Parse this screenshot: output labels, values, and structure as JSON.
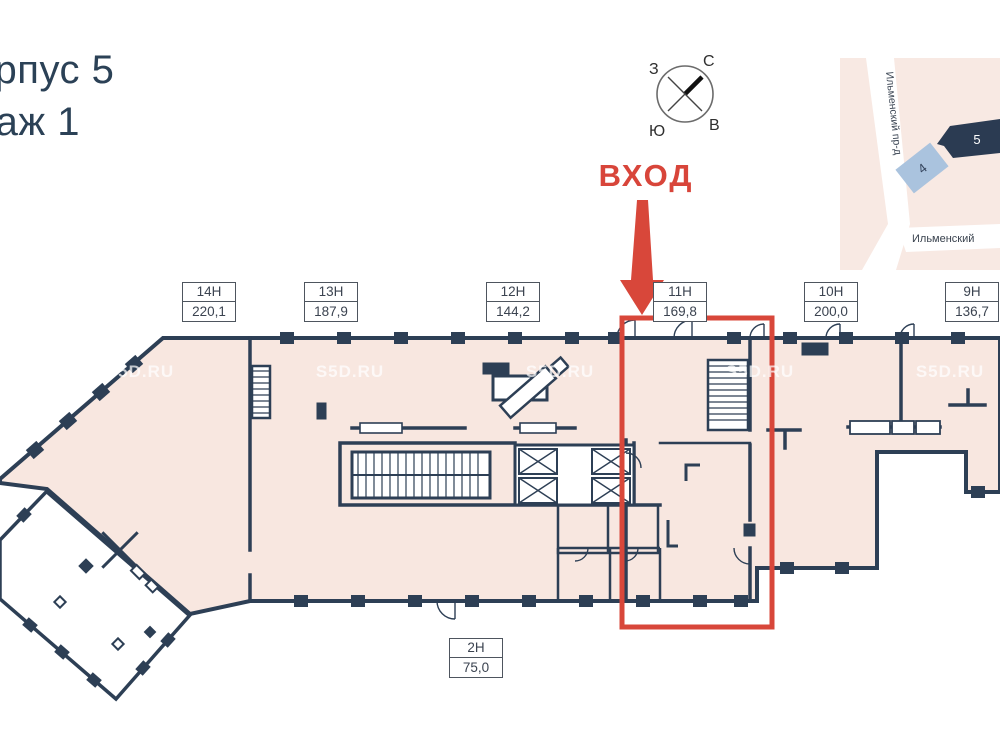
{
  "title": {
    "line1": "Корпус 5",
    "line2": "Этаж 1"
  },
  "entrance_label": "ВХОД",
  "compass": {
    "north": "С",
    "south": "Ю",
    "west": "З",
    "east": "В"
  },
  "map": {
    "street_vertical": "Ильменский пр-д",
    "street_horizontal": "Ильменский",
    "building4": "4",
    "building5": "5"
  },
  "watermark": {
    "text": "S5D.RU"
  },
  "units": [
    {
      "id": "14Н",
      "area": "220,1"
    },
    {
      "id": "13Н",
      "area": "187,9"
    },
    {
      "id": "12Н",
      "area": "144,2"
    },
    {
      "id": "11Н",
      "area": "169,8",
      "highlighted": true
    },
    {
      "id": "10Н",
      "area": "200,0"
    },
    {
      "id": "9Н",
      "area": "136,7"
    },
    {
      "id": "2Н",
      "area": "75,0"
    }
  ],
  "colors": {
    "accent_red": "#d8473a",
    "wall_navy": "#2d3f55",
    "floor_fill": "#f8e7e0",
    "map_building_selected": "#2b3b52",
    "map_building_other": "#aac3de"
  }
}
